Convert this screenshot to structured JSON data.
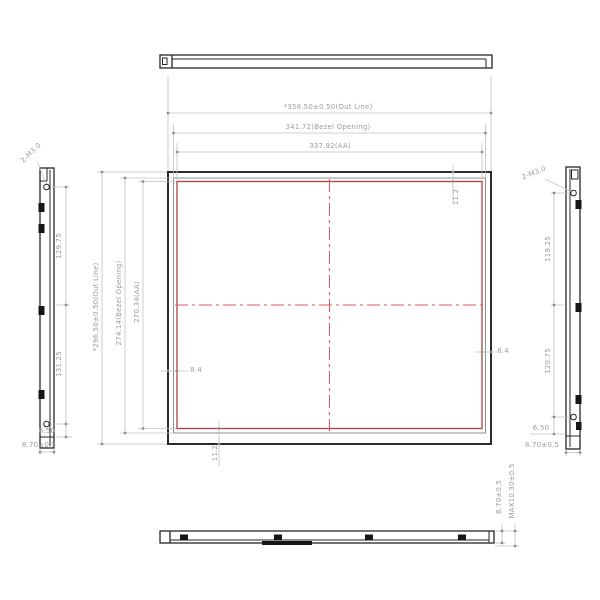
{
  "front_view": {
    "dim_width_outline": "*358.50±0.50(Out Line)",
    "dim_width_bezel": "341.72(Bezel Opening)",
    "dim_width_aa": "337.92(AA)",
    "dim_height_outline": "*296.50±0.50(Out Line)",
    "dim_height_bezel": "274.14(Bezel Opening)",
    "dim_height_aa": "270.34(AA)",
    "dim_bezel_top": "11.2",
    "dim_bezel_bottom": "11.2",
    "dim_bezel_left": "8.4",
    "dim_bezel_right": "8.4"
  },
  "left_side_view": {
    "screw_label": "2-M3.0",
    "dim_hole_upper": "129.75",
    "dim_hole_lower": "131.25",
    "dim_hole_edge": "6.50",
    "dim_thickness": "8.70±0.5"
  },
  "right_side_view": {
    "screw_label": "2-M3.0",
    "dim_hole_upper": "119.25",
    "dim_hole_lower": "120.75",
    "dim_hole_edge": "6.50",
    "dim_thickness": "8.70±0.5"
  },
  "bottom_view": {
    "dim_thickness": "8.70±0.5",
    "dim_max_thickness": "MAX10.30±0.5"
  },
  "colors": {
    "outline": "#2b2b2b",
    "bezel_line": "#8c8c8c",
    "active_area": "#b04040",
    "centerline": "#e05858",
    "dimension_line": "#c0c0c0",
    "dimension_text": "#9c9c9c"
  }
}
